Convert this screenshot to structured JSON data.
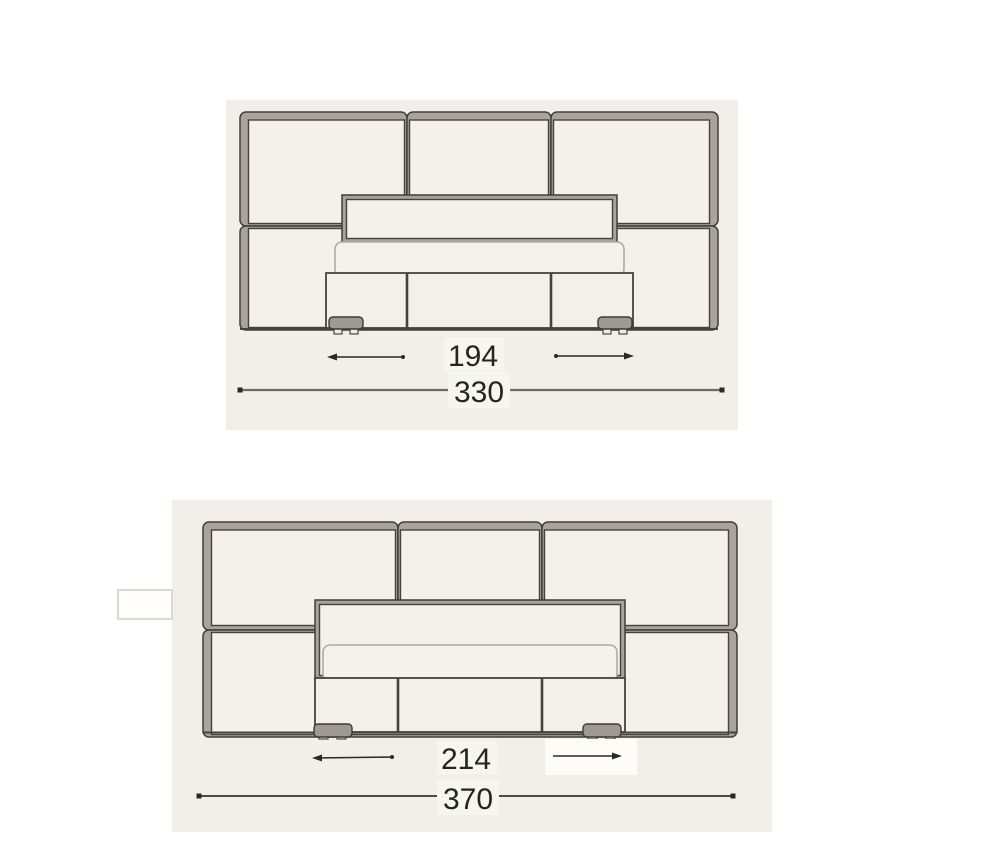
{
  "drawing": {
    "colors": {
      "sheet_background": "#f2eee8",
      "panel_frame_gray": "#a8a49d",
      "outline_dark": "#403e39",
      "dimension_text": "#26241f",
      "page_background": "#ffffff"
    },
    "diagrams": [
      {
        "inner_dimension": "194",
        "overall_dimension": "330"
      },
      {
        "inner_dimension": "214",
        "overall_dimension": "370"
      }
    ]
  }
}
